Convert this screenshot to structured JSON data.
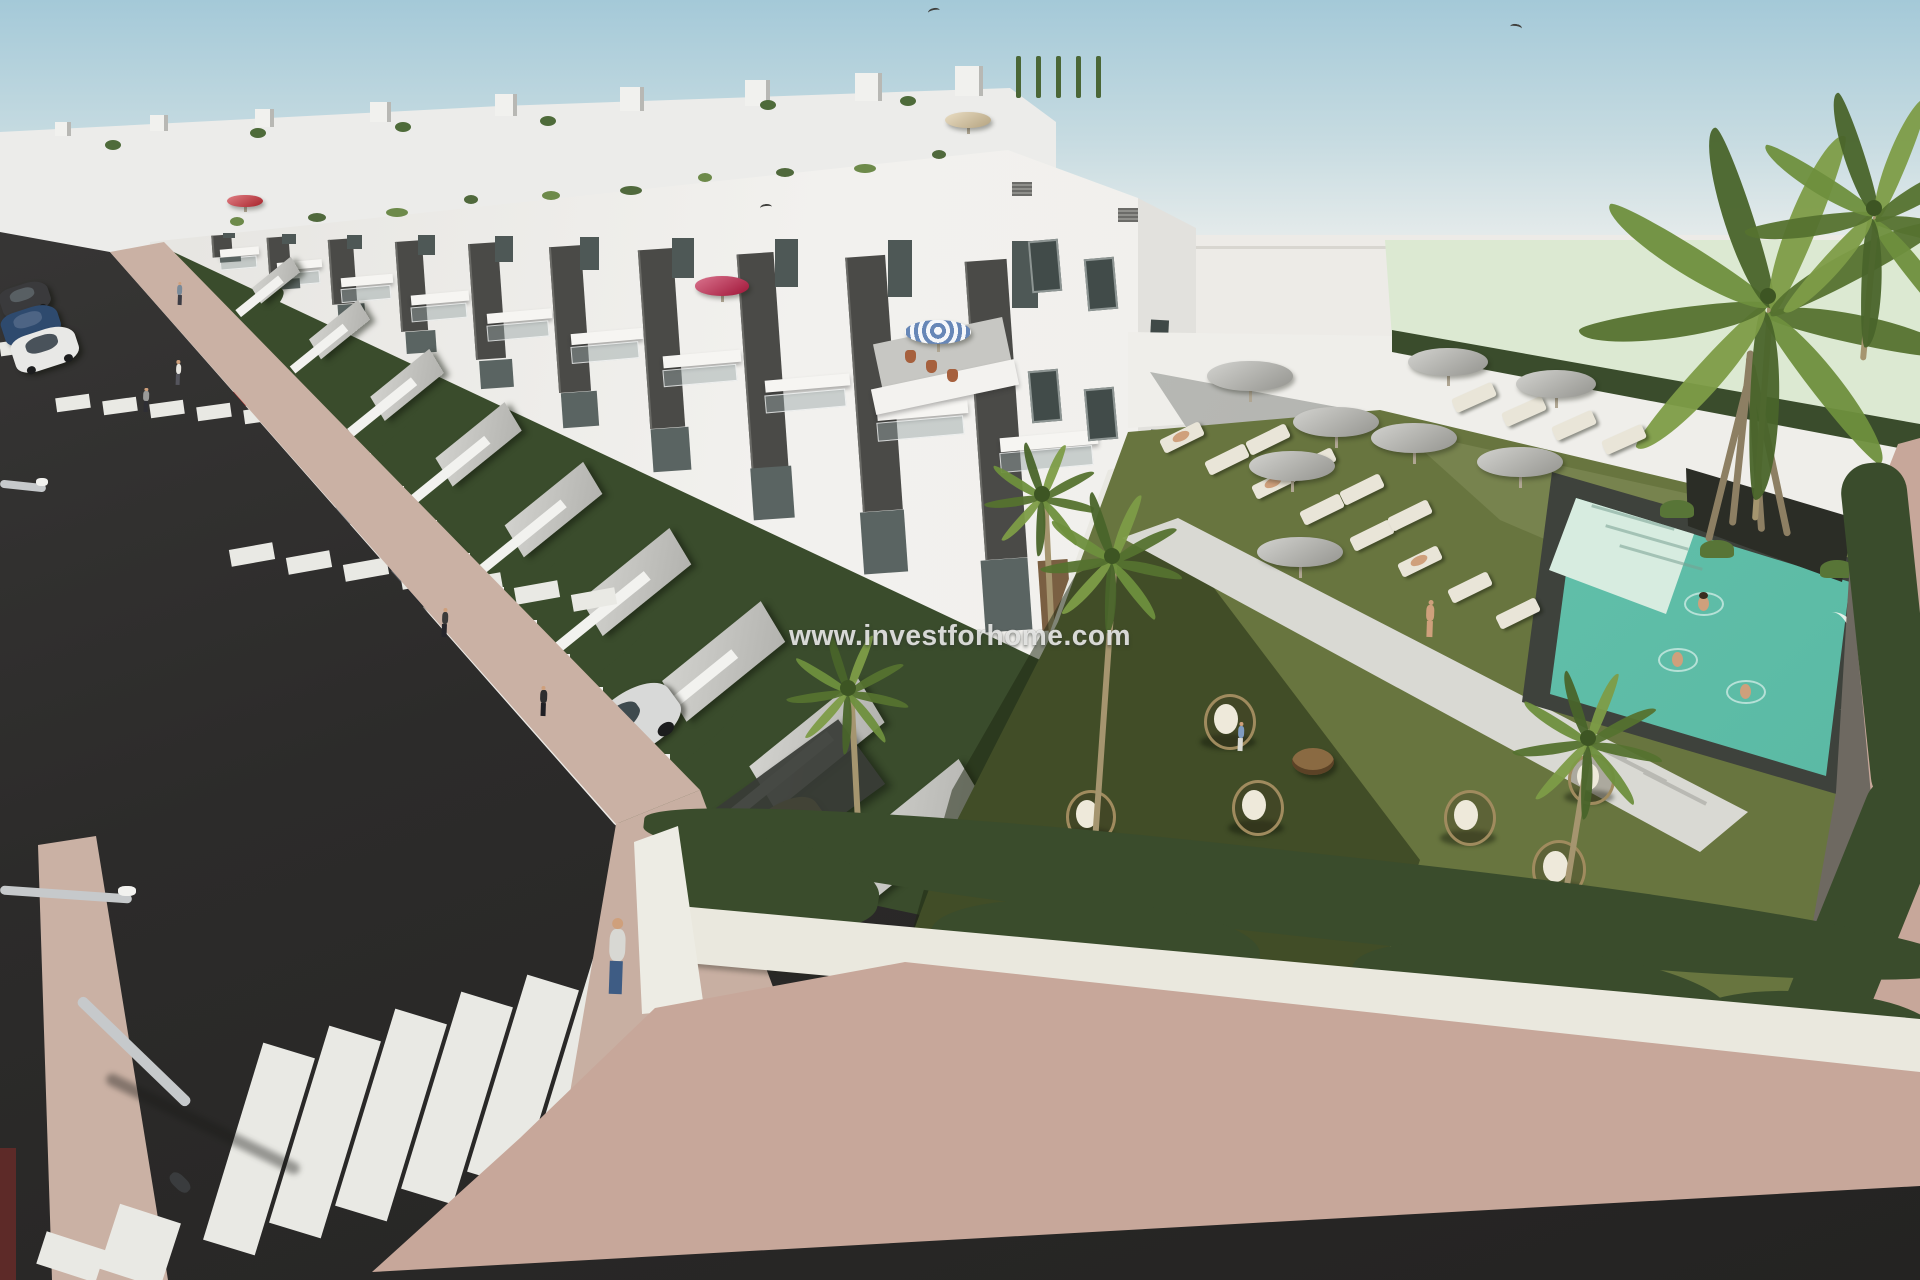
{
  "watermark": {
    "text": "www.investforhome.com"
  },
  "palette": {
    "sky_top": "#a4c9d8",
    "sky_mid": "#c6dbe1",
    "sky_horizon": "#e9edec",
    "backdrop": "#edebe7",
    "mint": "#dce9d2",
    "building_white": "#f4f3f0",
    "building_shade": "#cfcfca",
    "panel_dark": "#4a4a47",
    "glass": "#5a6462",
    "wood": "#7a5f42",
    "hedge": "#3a4c2c",
    "lawn": "#68753f",
    "lawn_shadow": "#3d4826",
    "pool_water_light": "#93d6c4",
    "pool_water": "#62c0aa",
    "pool_steps": "#d7ece0",
    "pool_deck": "#3e423c",
    "stone_wall": "#6e6961",
    "asphalt": "#2c2b2a",
    "asphalt_light": "#3a3938",
    "stripe_white": "#e9e9e4",
    "sidewalk_tan": "#cab1a4",
    "pavers_pink": "#c7a79a",
    "umbrella_gray": "#b5b5af",
    "umbrella_red": "#cc2a33",
    "umbrella_crimson": "#c21843",
    "umbrella_green": "#3e7d5a",
    "umbrella_beige": "#dcc79c",
    "umbrella_stripe_blue": "#6787b7",
    "lounger": "#e9e5d8",
    "rattan": "#a08b5e",
    "table_wood": "#8a6a42",
    "skin": "#cfa07c",
    "car_silver": "#d8d9d8",
    "car_yellow": "#c3a23e",
    "car_dark": "#24282c",
    "car_blue": "#2e4a6e",
    "car_white": "#e8e8e6",
    "pole_gray": "#c6c9cb"
  }
}
